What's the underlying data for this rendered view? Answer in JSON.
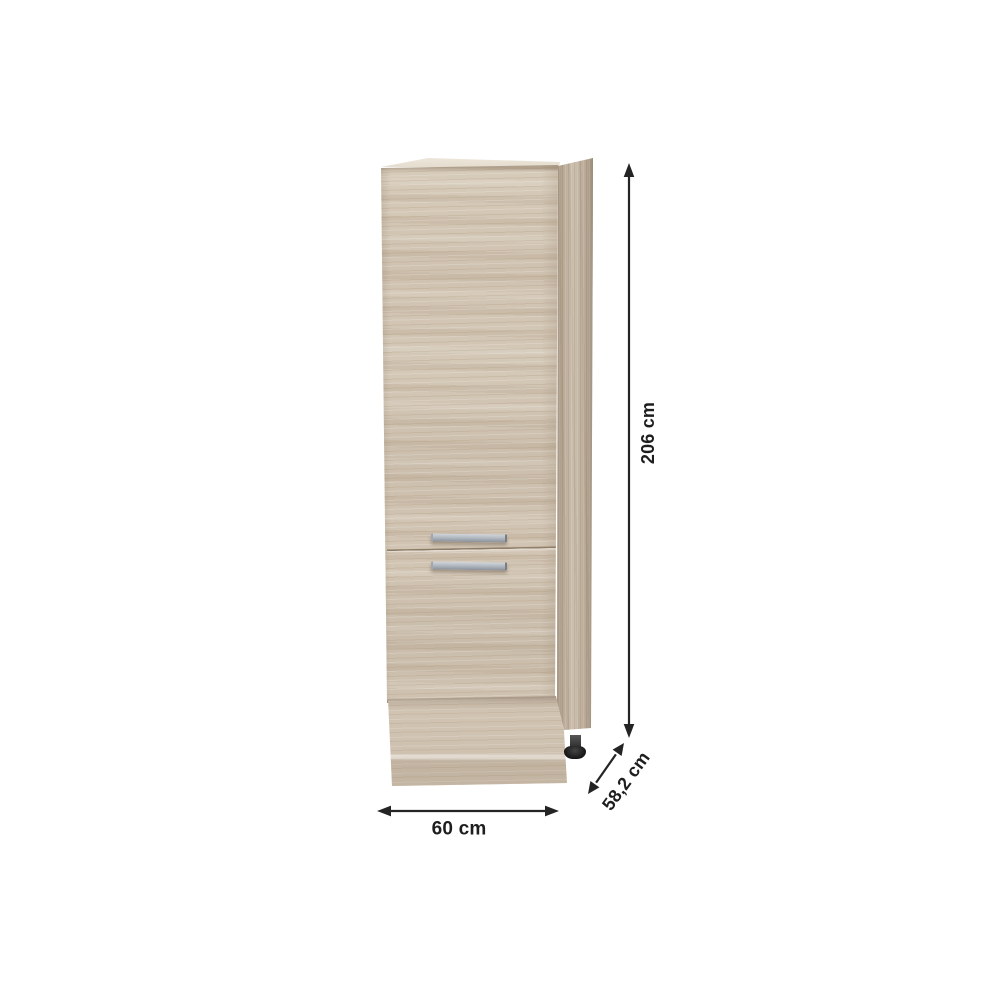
{
  "image": {
    "description": "Tall kitchen pantry cabinet with two doors in light sonoma oak, shown with dimension arrows",
    "background_color": "#ffffff"
  },
  "dimensions": {
    "height": {
      "label": "206 cm"
    },
    "depth": {
      "label": "58,2 cm"
    },
    "width": {
      "label": "60 cm"
    }
  },
  "cabinet": {
    "front_wood_color": "#cfc2b0",
    "side_wood_color": "#c6b8a5",
    "top_panel_color": "#e9e2d6",
    "handle_color": "#b4bac2",
    "foot_color": "#1c1c1c"
  },
  "annotation": {
    "ink_color": "#242424",
    "arrow_icons": [
      "up-down-arrow-icon",
      "left-right-arrow-icon",
      "diagonal-arrow-icon"
    ]
  }
}
